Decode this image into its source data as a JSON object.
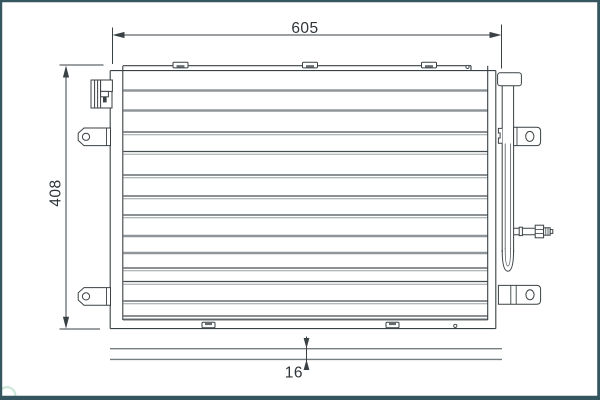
{
  "drawing": {
    "dimensions": {
      "width_mm": "605",
      "height_mm": "408",
      "depth_mm": "16"
    }
  },
  "colors": {
    "frame_border": "#35565e",
    "line_dark": "#3a4144",
    "line_gray": "#8e969a",
    "dimension_text": "#2f3438",
    "background": "#ffffff",
    "watermark_green": "#c9e7d5"
  }
}
